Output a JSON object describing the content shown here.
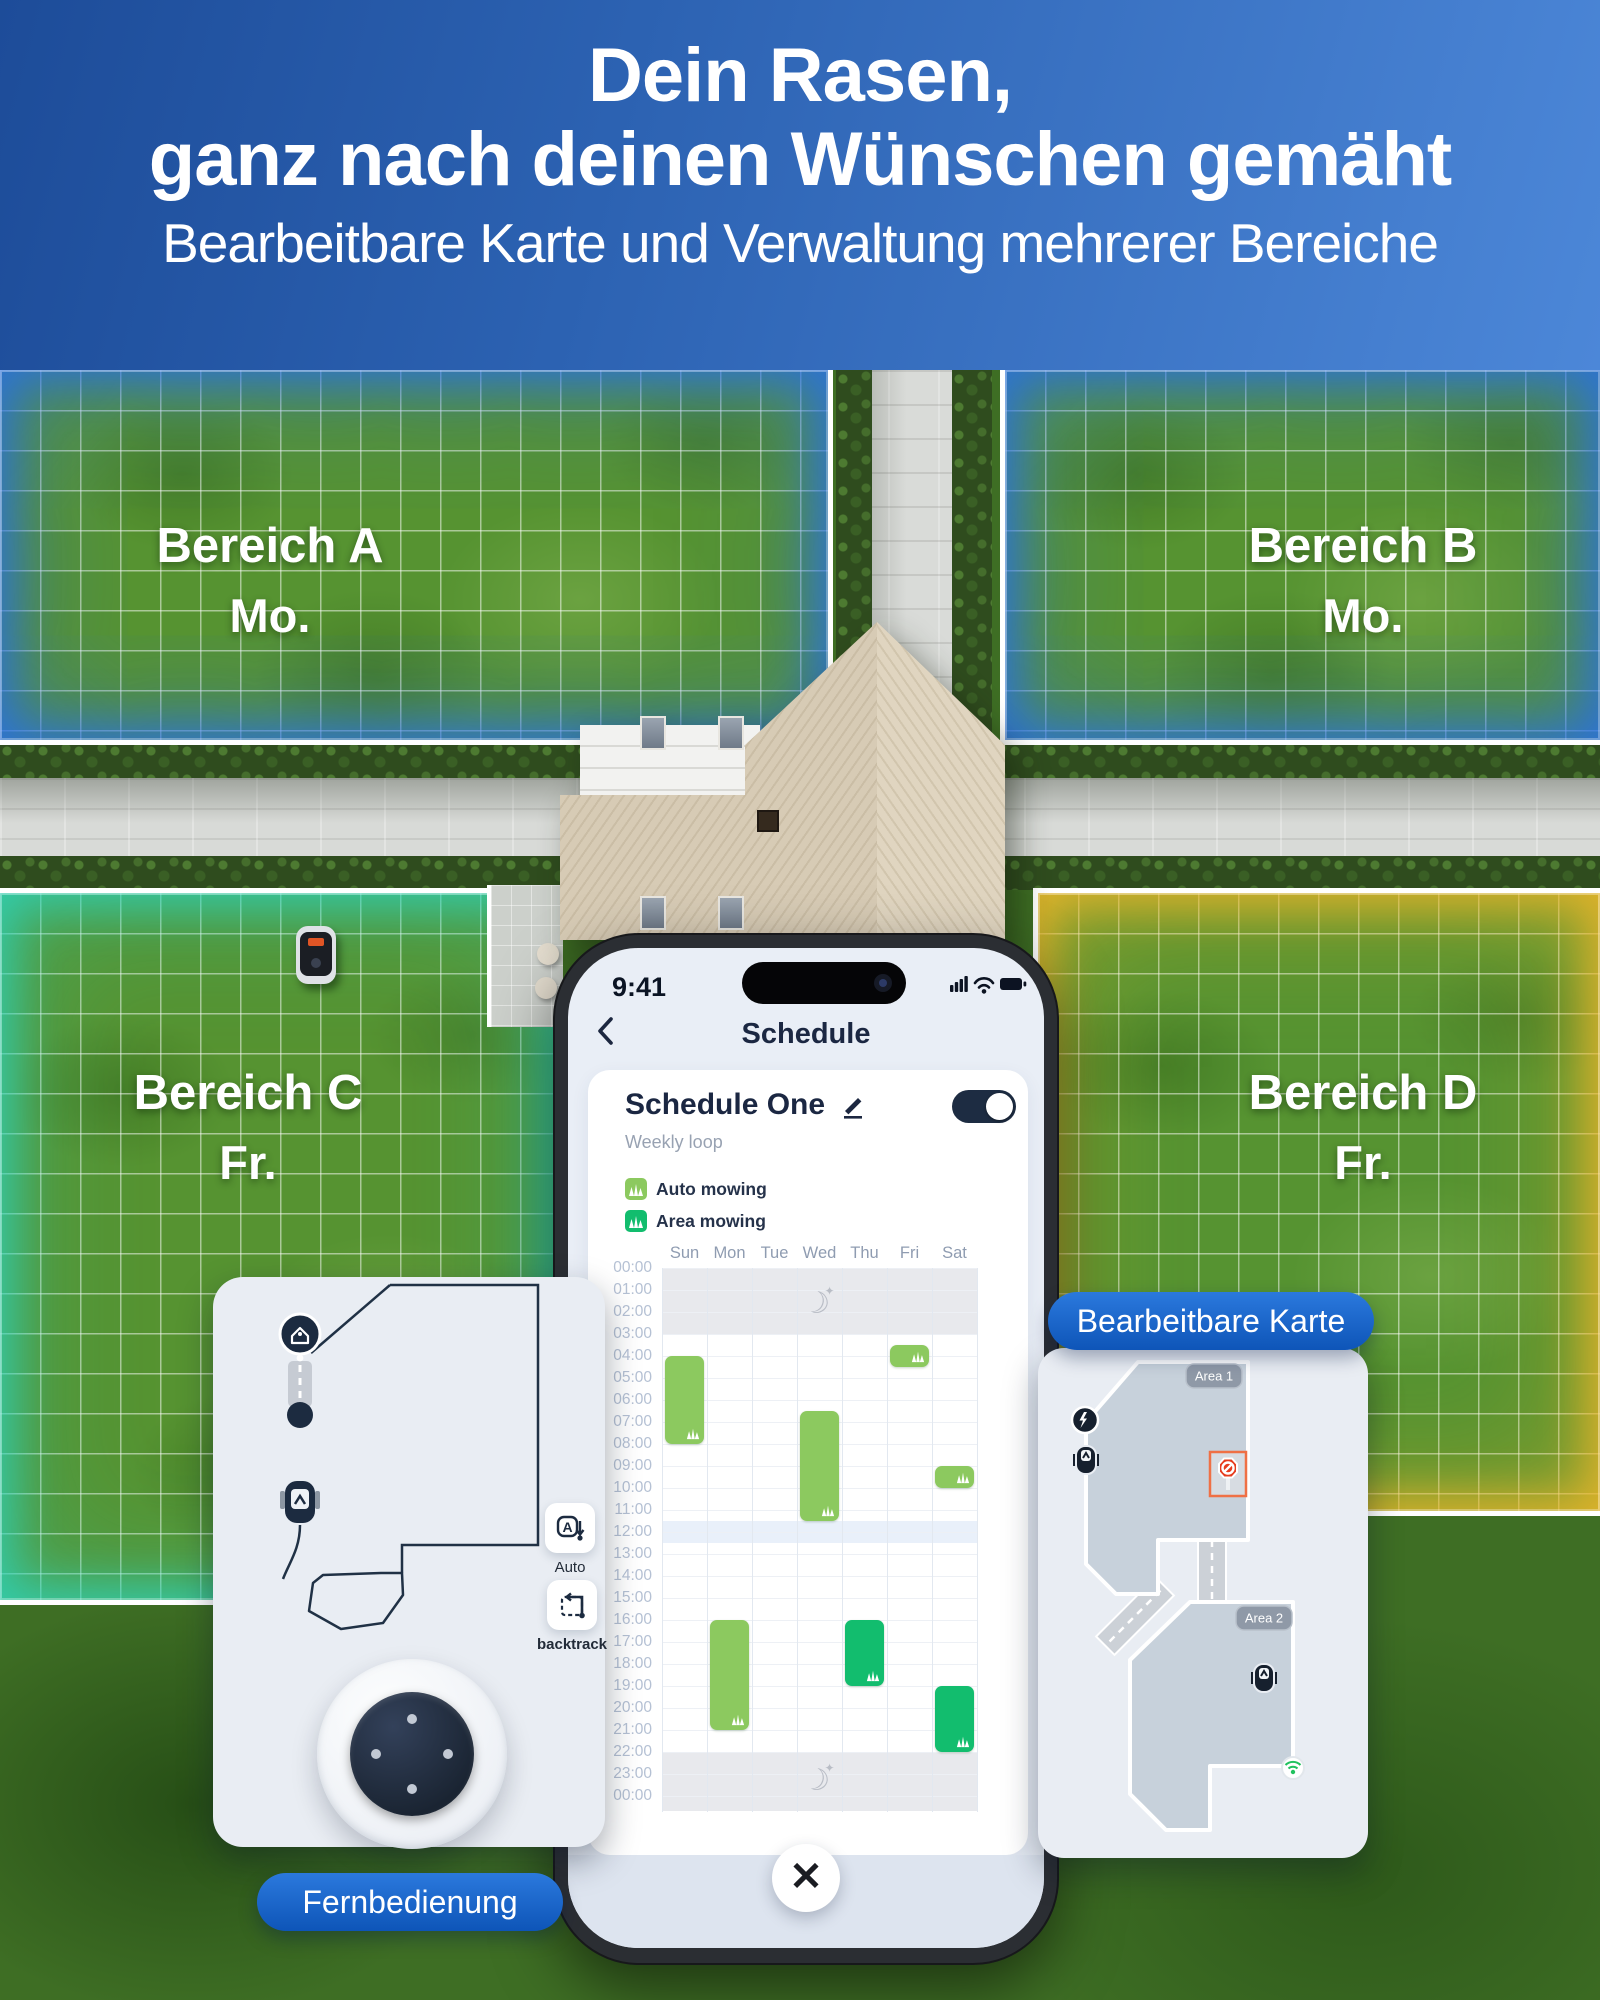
{
  "header": {
    "title_line1": "Dein Rasen,",
    "title_line2": "ganz nach deinen Wünschen gemäht",
    "subtitle": "Bearbeitbare Karte und Verwaltung mehrerer Bereiche"
  },
  "scene": {
    "areas": [
      {
        "name": "Bereich A",
        "day": "Mo.",
        "accent": "#2a6ee9"
      },
      {
        "name": "Bereich B",
        "day": "Mo.",
        "accent": "#2a6ee9"
      },
      {
        "name": "Bereich C",
        "day": "Fr.",
        "accent": "#2dd4be"
      },
      {
        "name": "Bereich D",
        "day": "Fr.",
        "accent": "#eeb62a"
      }
    ]
  },
  "phone": {
    "status": {
      "time": "9:41"
    },
    "nav": {
      "title": "Schedule"
    },
    "schedule": {
      "name": "Schedule One",
      "subtitle": "Weekly loop",
      "legend": [
        {
          "label": "Auto mowing",
          "color": "#8cc95f"
        },
        {
          "label": "Area mowing",
          "color": "#12bd6e"
        }
      ],
      "days": [
        "Sun",
        "Mon",
        "Tue",
        "Wed",
        "Thu",
        "Fri",
        "Sat"
      ],
      "hours": [
        "00:00",
        "01:00",
        "02:00",
        "03:00",
        "04:00",
        "05:00",
        "06:00",
        "07:00",
        "08:00",
        "09:00",
        "10:00",
        "11:00",
        "12:00",
        "13:00",
        "14:00",
        "15:00",
        "16:00",
        "17:00",
        "18:00",
        "19:00",
        "20:00",
        "21:00",
        "22:00",
        "23:00",
        "00:00"
      ],
      "blocks": [
        {
          "day": "Sun",
          "start": 4,
          "end": 8,
          "type": "auto"
        },
        {
          "day": "Wed",
          "start": 6.5,
          "end": 11.5,
          "type": "auto"
        },
        {
          "day": "Fri",
          "start": 3.5,
          "end": 4.5,
          "type": "auto"
        },
        {
          "day": "Sat",
          "start": 9,
          "end": 10,
          "type": "auto"
        },
        {
          "day": "Mon",
          "start": 16,
          "end": 21,
          "type": "auto"
        },
        {
          "day": "Thu",
          "start": 16,
          "end": 19,
          "type": "area"
        },
        {
          "day": "Sat",
          "start": 19,
          "end": 22,
          "type": "area"
        }
      ],
      "quiet_bands": [
        {
          "from": 0,
          "to": 3
        },
        {
          "from": 22,
          "to": 24.7
        }
      ],
      "noon_band": {
        "from": 11.5,
        "to": 12.5
      },
      "moons": [
        {
          "day": "Wed",
          "hour": 1.5
        },
        {
          "day": "Wed",
          "hour": 23.2
        }
      ],
      "toggle_on": true
    }
  },
  "remote": {
    "label": "Fernbedienung",
    "buttons": [
      {
        "id": "auto",
        "label": "Auto"
      },
      {
        "id": "backtrack",
        "label": "backtrack"
      }
    ]
  },
  "map": {
    "label": "Bearbeitbare Karte",
    "areas": [
      {
        "name": "Area 1"
      },
      {
        "name": "Area 2"
      }
    ]
  },
  "icons": {
    "back": "‹",
    "close": "✕",
    "moon": "☾",
    "star": "✦",
    "edit": "pencil-icon",
    "status": [
      "signal-icon",
      "wifi-icon",
      "battery-icon"
    ]
  },
  "colors": {
    "auto_green": "#8cc95f",
    "area_green": "#12bd6e",
    "toggle": "#1d2c42",
    "pill_blue_top": "#2b79dd",
    "pill_blue_bottom": "#0e55b8",
    "navy_icon": "#1c2b40",
    "quiet_band": "#e8e9ed"
  }
}
